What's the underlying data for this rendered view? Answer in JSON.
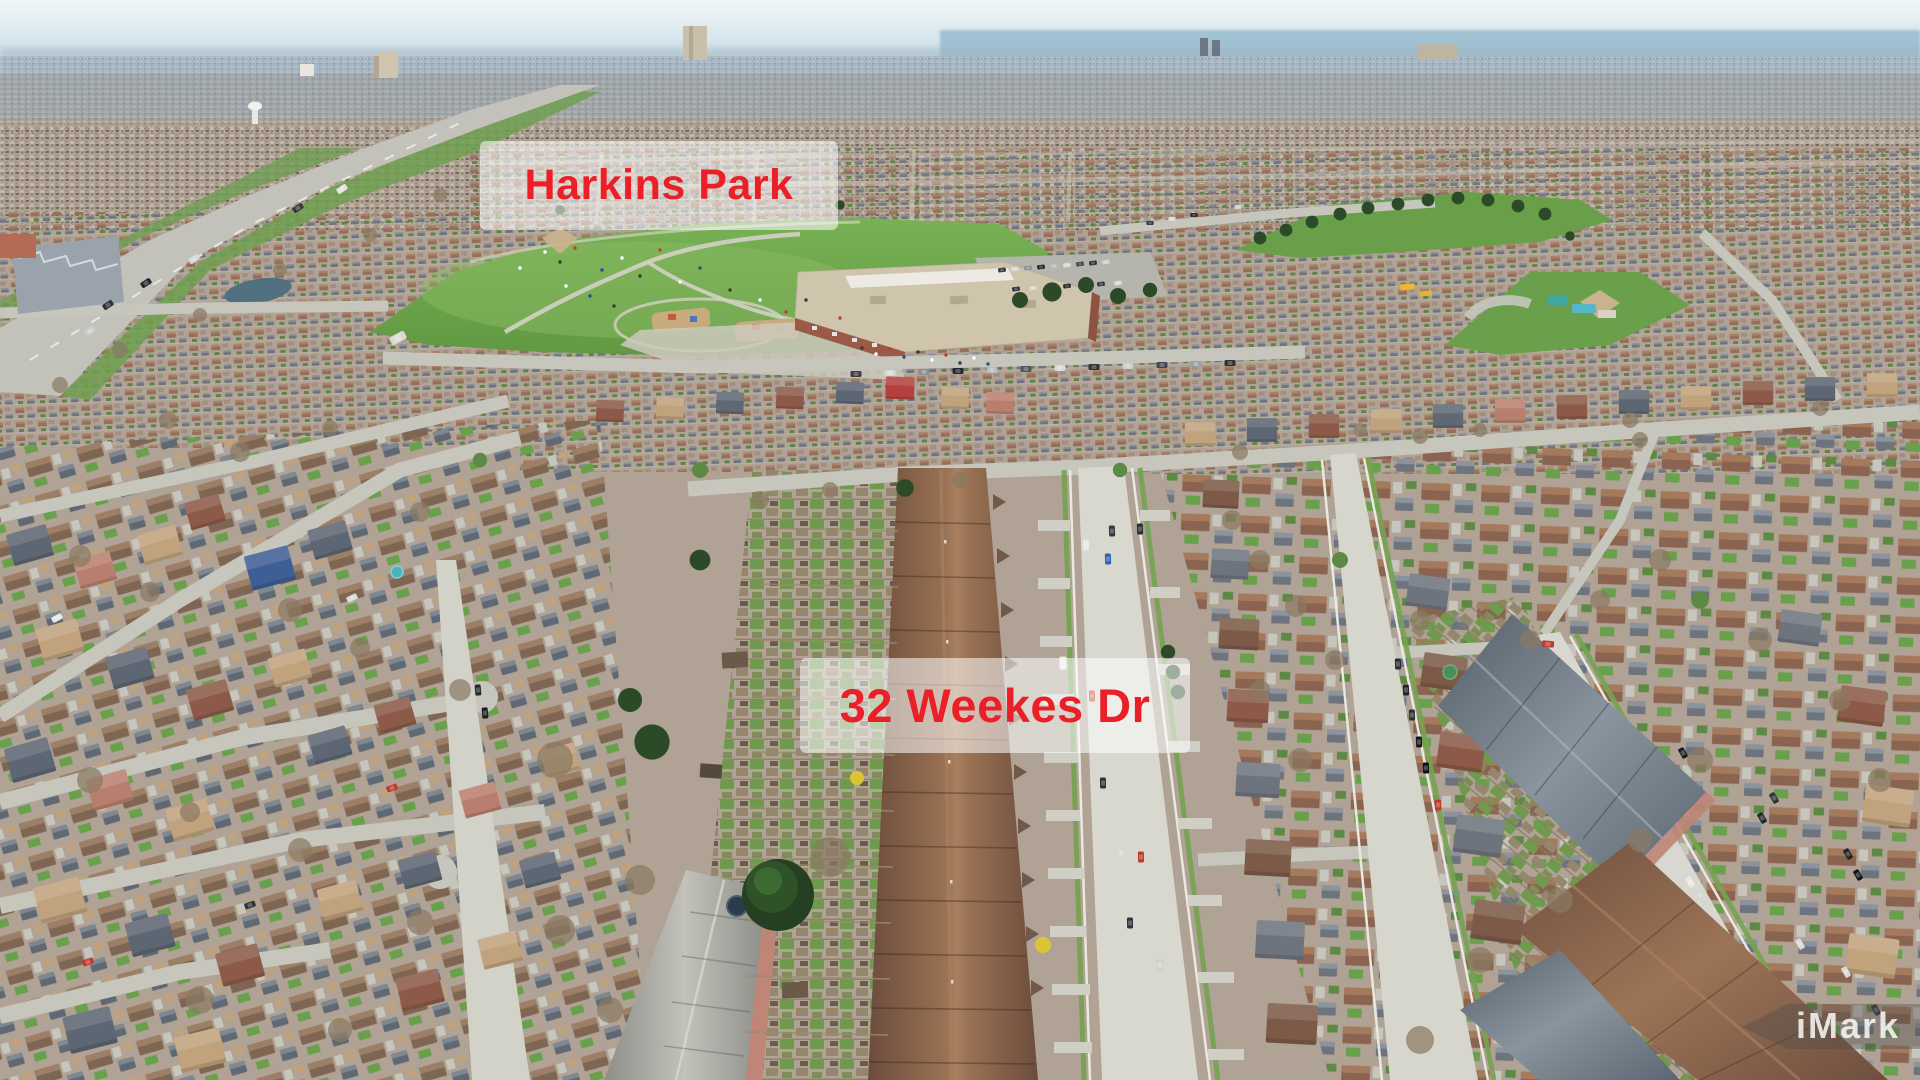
{
  "labels": {
    "park": {
      "text": "Harkins Park"
    },
    "address": {
      "text": "32 Weekes Dr"
    }
  },
  "watermark": {
    "text": "iMark"
  },
  "palette": {
    "label_text": "#eb1f27",
    "label_background": "rgba(255,255,255,0.55)",
    "watermark_text": "rgba(255,255,255,0.82)",
    "watermark_badge": "rgba(75,75,75,0.38)",
    "sky": "#c6dbe7",
    "lake": "#8fb6cb",
    "park_grass": "#6fae4e",
    "roof_brown": "#7b5b49",
    "roof_gray": "#6e747e",
    "brick": "#c08776",
    "road_asphalt": "#c3c3ba",
    "road_concrete": "#d8d8cf",
    "conifer": "#2c4a28",
    "bare_tree": "#8a7a64",
    "school_roof": "#cdc3a9"
  }
}
